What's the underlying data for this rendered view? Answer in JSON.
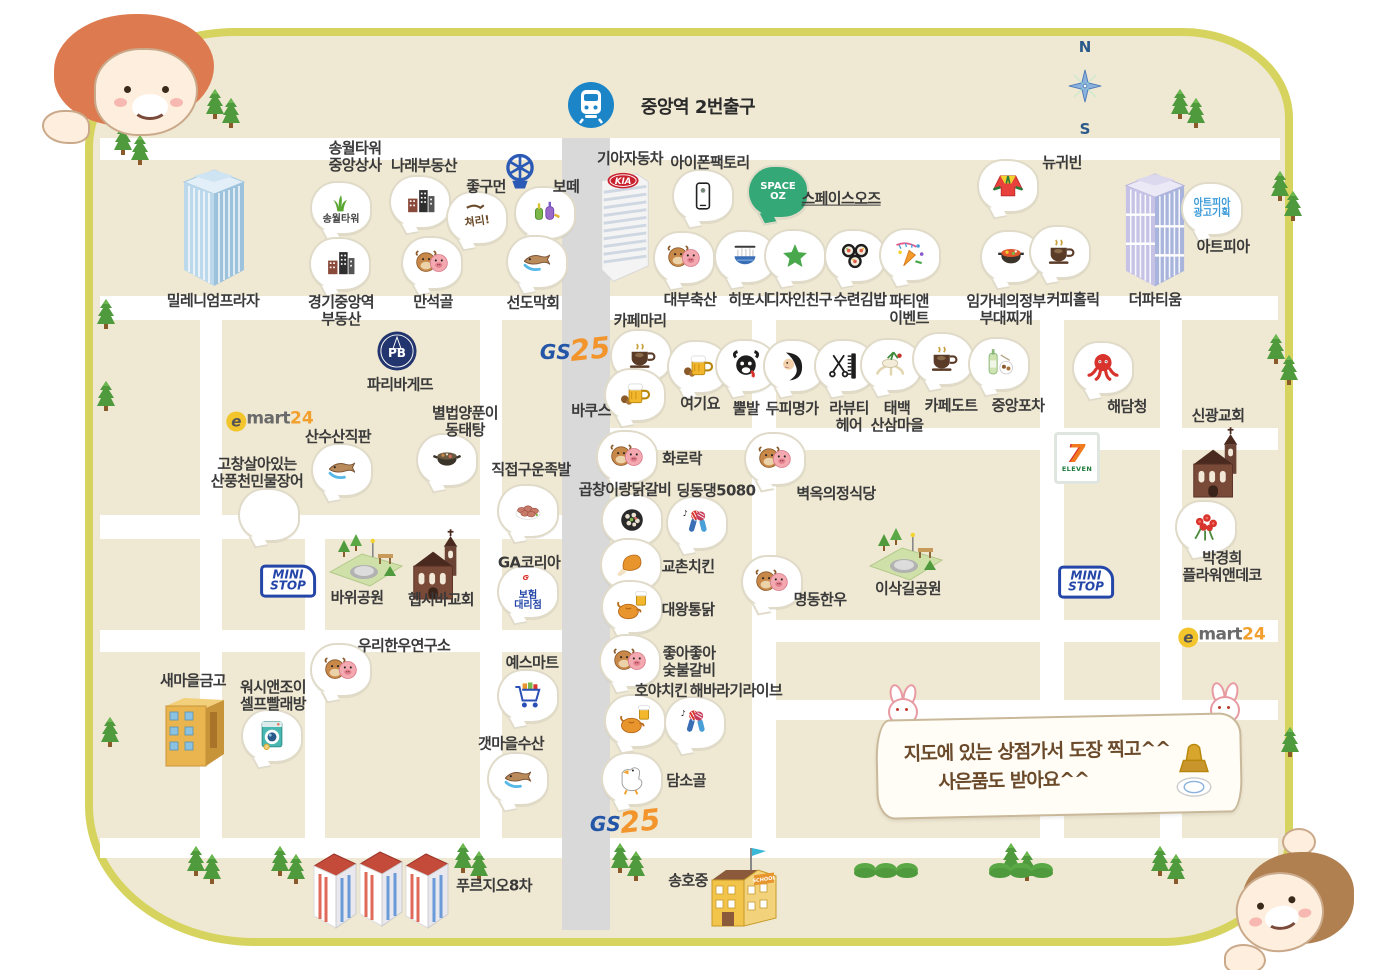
{
  "map": {
    "station_label": "중앙역 2번출구",
    "compass": {
      "n": "N",
      "s": "S"
    },
    "banner": {
      "line1": "지도에 있는 상점가서 도장 찍고^^",
      "line2": "사은품도 받아요^^"
    },
    "colors": {
      "border": "#d6d45f",
      "base": "#efe8d2",
      "road": "#ffffff",
      "main_road": "#d9d9d9",
      "station_blue": "#1b85c8"
    }
  },
  "logos": [
    {
      "name": "gs25-north",
      "kind": "gs25",
      "x": 575,
      "y": 349,
      "t1": "GS",
      "t2": "25"
    },
    {
      "name": "gs25-south",
      "kind": "gs25",
      "x": 625,
      "y": 821,
      "t1": "GS",
      "t2": "25"
    },
    {
      "name": "emart24-west",
      "kind": "emart",
      "x": 270,
      "y": 420,
      "t1": "e",
      "t2": "mart",
      "t3": "24"
    },
    {
      "name": "emart24-east",
      "kind": "emart",
      "x": 1222,
      "y": 636,
      "t1": "e",
      "t2": "mart",
      "t3": "24"
    },
    {
      "name": "ministop-west",
      "kind": "ministop",
      "x": 288,
      "y": 581,
      "t1": "MINI",
      "t2": "STOP"
    },
    {
      "name": "ministop-east",
      "kind": "ministop",
      "x": 1086,
      "y": 582,
      "t1": "MINI",
      "t2": "STOP"
    },
    {
      "name": "seven-eleven",
      "kind": "seven",
      "x": 1077,
      "y": 458,
      "t1": "7",
      "t2": "ELEVEN"
    }
  ],
  "buildings": [
    {
      "name": "millennium-plaza",
      "type": "tower_blue",
      "x": 178,
      "y": 168,
      "label": "밀레니엄프라자",
      "lx": 213,
      "ly": 301
    },
    {
      "name": "the-partium",
      "type": "tower_lav",
      "x": 1120,
      "y": 172,
      "label": "더파티움",
      "lx": 1155,
      "ly": 300
    },
    {
      "name": "kia-motors",
      "type": "kia",
      "x": 594,
      "y": 168,
      "sign": "KIA",
      "label": "기아자동차",
      "lx": 630,
      "ly": 159
    },
    {
      "name": "saemaul-geumgo",
      "type": "bank",
      "x": 158,
      "y": 690,
      "label": "새마을금고",
      "lx": 193,
      "ly": 681
    },
    {
      "name": "shinkwang-church",
      "type": "church",
      "x": 1186,
      "y": 424,
      "label": "신광교회",
      "lx": 1218,
      "ly": 416
    },
    {
      "name": "hepsibah-church",
      "type": "church",
      "x": 406,
      "y": 526,
      "label": "헵시바교회",
      "lx": 441,
      "ly": 600
    },
    {
      "name": "bawi-park",
      "type": "park",
      "x": 320,
      "y": 528,
      "label": "바위공원",
      "lx": 357,
      "ly": 598
    },
    {
      "name": "isakgil-park",
      "type": "park",
      "x": 860,
      "y": 522,
      "label": "이삭길공원",
      "lx": 908,
      "ly": 589
    },
    {
      "name": "prugio-8",
      "type": "apartments",
      "x": 312,
      "y": 850,
      "label": "푸르지오8차",
      "lx": 494,
      "ly": 886
    },
    {
      "name": "songho-middle-school",
      "type": "school",
      "x": 706,
      "y": 846,
      "sign": "SCHOOL",
      "label": "송호중",
      "lx": 688,
      "ly": 881
    }
  ],
  "pois": [
    {
      "name": "songwol-tower-jungang-sangsa",
      "icon": "grass",
      "bubble_text": "송월타워",
      "x": 341,
      "y": 208,
      "label": "송월타워\n중앙상사",
      "lx": 355,
      "ly": 157
    },
    {
      "name": "narae-budongsan",
      "icon": "buildings",
      "x": 420,
      "y": 202,
      "label": "나래부동산",
      "lx": 424,
      "ly": 166
    },
    {
      "name": "jokumeon",
      "icon": "calligraphy",
      "icon_text": "쳐리!",
      "x": 477,
      "y": 218,
      "label": "좋구먼",
      "lx": 486,
      "ly": 187
    },
    {
      "name": "botte",
      "icon": "perfume",
      "x": 545,
      "y": 213,
      "label": "보떼",
      "lx": 566,
      "ly": 187
    },
    {
      "name": "blue-emblem",
      "icon": "emblem",
      "flat": true,
      "x": 520,
      "y": 172,
      "label": ""
    },
    {
      "name": "gyeonggi-jungang-station-budongsan",
      "icon": "buildings",
      "x": 340,
      "y": 264,
      "label": "경기중앙역\n부동산",
      "lx": 341,
      "ly": 311
    },
    {
      "name": "manseokgol",
      "icon": "cowpig",
      "x": 432,
      "y": 263,
      "label": "만석골",
      "lx": 433,
      "ly": 302
    },
    {
      "name": "seondo-makhoe",
      "icon": "fish",
      "x": 537,
      "y": 262,
      "label": "선도막회",
      "lx": 533,
      "ly": 303
    },
    {
      "name": "iphone-factory",
      "icon": "phone",
      "x": 703,
      "y": 196,
      "label": "아이폰팩토리",
      "lx": 710,
      "ly": 163
    },
    {
      "name": "space-oz",
      "icon": "",
      "bubble_text": "SPACE\nOZ",
      "bc": "#35a878",
      "tc": "#ffffff",
      "x": 778,
      "y": 192,
      "label": "스페이스오즈",
      "lx": 841,
      "ly": 199,
      "underline": true
    },
    {
      "name": "daebu-chuksan",
      "icon": "cowpig",
      "x": 684,
      "y": 258,
      "label": "대부축산",
      "lx": 690,
      "ly": 300
    },
    {
      "name": "hittoshi",
      "icon": "noodles",
      "x": 745,
      "y": 257,
      "label": "히또시",
      "lx": 748,
      "ly": 300
    },
    {
      "name": "design-chingu",
      "icon": "star",
      "x": 795,
      "y": 256,
      "label": "디자인친구",
      "lx": 799,
      "ly": 300
    },
    {
      "name": "suryeon-gimbap",
      "icon": "gimbap",
      "x": 855,
      "y": 256,
      "label": "수련김밥",
      "lx": 860,
      "ly": 300
    },
    {
      "name": "party-n-event",
      "icon": "party",
      "x": 910,
      "y": 255,
      "label": "파티앤\n이벤트",
      "lx": 909,
      "ly": 310
    },
    {
      "name": "imgane-uijeongbu-budae-jjigae",
      "icon": "hotpot",
      "x": 1011,
      "y": 257,
      "label": "임가네의정부\n부대찌개",
      "lx": 1006,
      "ly": 310
    },
    {
      "name": "coffee-holic",
      "icon": "coffee",
      "x": 1060,
      "y": 252,
      "label": "커피홀릭",
      "lx": 1073,
      "ly": 300
    },
    {
      "name": "new-gwibin",
      "icon": "hanbok",
      "x": 1008,
      "y": 186,
      "label": "뉴귀빈",
      "lx": 1062,
      "ly": 163
    },
    {
      "name": "artpia-ad-planning",
      "icon": "",
      "bubble_text": "아트피아\n광고기획",
      "tc": "#3a9ad8",
      "x": 1212,
      "y": 209,
      "label": "아트피아",
      "lx": 1223,
      "ly": 247
    },
    {
      "name": "cafe-mari",
      "icon": "coffee",
      "x": 641,
      "y": 356,
      "label": "카페마리",
      "lx": 640,
      "ly": 321
    },
    {
      "name": "bacchus",
      "icon": "beer",
      "x": 635,
      "y": 395,
      "label": "바쿠스",
      "lx": 591,
      "ly": 411
    },
    {
      "name": "yeogiyo",
      "icon": "beer",
      "x": 698,
      "y": 367,
      "label": "여기요",
      "lx": 700,
      "ly": 404
    },
    {
      "name": "ppulbal",
      "icon": "bull",
      "x": 746,
      "y": 366,
      "label": "뿔발",
      "lx": 746,
      "ly": 409
    },
    {
      "name": "dupi-myeongga",
      "icon": "scalp",
      "x": 794,
      "y": 366,
      "label": "두피명가",
      "lx": 792,
      "ly": 409
    },
    {
      "name": "la-beauty-hair",
      "icon": "scissors",
      "x": 845,
      "y": 366,
      "label": "라뷰티\n헤어",
      "lx": 849,
      "ly": 417
    },
    {
      "name": "taebaek-sansam-maeul",
      "icon": "ginseng",
      "x": 891,
      "y": 365,
      "label": "태백\n산삼마을",
      "lx": 897,
      "ly": 417
    },
    {
      "name": "cafe-dot",
      "icon": "coffee",
      "x": 943,
      "y": 359,
      "label": "카페도트",
      "lx": 951,
      "ly": 406
    },
    {
      "name": "jungang-pocha",
      "icon": "soju",
      "x": 999,
      "y": 364,
      "label": "중앙포차",
      "lx": 1018,
      "ly": 406
    },
    {
      "name": "haedamcheong",
      "icon": "octopus",
      "x": 1103,
      "y": 368,
      "label": "해담청",
      "lx": 1127,
      "ly": 407
    },
    {
      "name": "paris-baguette",
      "icon": "pb",
      "sign": "PB",
      "flat": true,
      "x": 397,
      "y": 351,
      "label": "파리바게뜨",
      "lx": 400,
      "ly": 385
    },
    {
      "name": "sansusan-jikpan",
      "icon": "fish",
      "x": 342,
      "y": 470,
      "label": "산수산직판",
      "lx": 338,
      "ly": 437
    },
    {
      "name": "byeolbeop-yangpuni-dongtaetang",
      "icon": "pot",
      "x": 447,
      "y": 460,
      "label": "별법양푼이\n동태탕",
      "lx": 465,
      "ly": 422
    },
    {
      "name": "gochang-minmul-jangeo",
      "icon": "eel",
      "x": 269,
      "y": 515,
      "label": "고창살아있는\n산풍천민물장어",
      "lx": 257,
      "ly": 473
    },
    {
      "name": "jikjeop-guun-jokbal",
      "icon": "pork",
      "x": 528,
      "y": 511,
      "label": "직접구운족발",
      "lx": 531,
      "ly": 470
    },
    {
      "name": "hwarorak",
      "icon": "cowpig",
      "x": 627,
      "y": 457,
      "label": "화로락",
      "lx": 682,
      "ly": 459
    },
    {
      "name": "gopchang-irang-dakgalbi",
      "icon": "pan",
      "x": 632,
      "y": 520,
      "label": "곱창이랑닭갈비",
      "lx": 625,
      "ly": 490
    },
    {
      "name": "dingdongdaeng-5080",
      "icon": "mics",
      "x": 697,
      "y": 523,
      "label": "딩동댕5080",
      "lx": 716,
      "ly": 491
    },
    {
      "name": "byeokok-uijeong-sikdang",
      "icon": "cowpig",
      "x": 775,
      "y": 459,
      "label": "벽옥의정식당",
      "lx": 836,
      "ly": 494
    },
    {
      "name": "kyochon-chicken",
      "icon": "chicken",
      "x": 631,
      "y": 565,
      "label": "교촌치킨",
      "lx": 688,
      "ly": 567
    },
    {
      "name": "daewang-tongdak",
      "icon": "chickbeer",
      "x": 632,
      "y": 607,
      "label": "대왕통닭",
      "lx": 688,
      "ly": 610
    },
    {
      "name": "myeongdong-hanwoo",
      "icon": "cowpig",
      "x": 772,
      "y": 582,
      "label": "명동한우",
      "lx": 820,
      "ly": 600
    },
    {
      "name": "ga-korea-insurance",
      "icon": "gmark",
      "bubble_text": "보험\n대리점",
      "tc": "#2446a8",
      "x": 528,
      "y": 592,
      "label": "GA코리아",
      "lx": 529,
      "ly": 563
    },
    {
      "name": "yes-mart",
      "icon": "cart",
      "x": 528,
      "y": 696,
      "label": "예스마트",
      "lx": 532,
      "ly": 663
    },
    {
      "name": "woori-hanwoo-yeonguso",
      "icon": "cowpig",
      "x": 341,
      "y": 670,
      "label": "우리한우연구소",
      "lx": 404,
      "ly": 646
    },
    {
      "name": "wash-n-joy-laundry",
      "icon": "washer",
      "x": 272,
      "y": 736,
      "label": "워시앤조이\n셀프빨래방",
      "lx": 273,
      "ly": 696
    },
    {
      "name": "gaetmaeul-susan",
      "icon": "fish",
      "x": 518,
      "y": 779,
      "label": "갯마을수산",
      "lx": 511,
      "ly": 744
    },
    {
      "name": "joajoa-sutbul-galbi",
      "icon": "cowpig",
      "x": 630,
      "y": 661,
      "label": "좋아좋아\n숯불갈비",
      "lx": 689,
      "ly": 662
    },
    {
      "name": "hoya-chicken",
      "icon": "chickbeer",
      "x": 635,
      "y": 721,
      "label": "호야치킨",
      "lx": 661,
      "ly": 691
    },
    {
      "name": "haebaragi-live",
      "icon": "mics",
      "x": 695,
      "y": 723,
      "label": "해바라기라이브",
      "lx": 736,
      "ly": 691
    },
    {
      "name": "damsogol",
      "icon": "duck",
      "x": 632,
      "y": 779,
      "label": "담소골",
      "lx": 686,
      "ly": 781
    },
    {
      "name": "park-kyunghee-flower-n-deco",
      "icon": "flowers",
      "x": 1206,
      "y": 527,
      "label": "박경희\n플라워앤데코",
      "lx": 1222,
      "ly": 567
    }
  ],
  "decor": {
    "trees": [
      [
        205,
        88
      ],
      [
        221,
        97
      ],
      [
        113,
        124
      ],
      [
        130,
        134
      ],
      [
        1170,
        88
      ],
      [
        1186,
        97
      ],
      [
        1270,
        170
      ],
      [
        1283,
        190
      ],
      [
        1266,
        333
      ],
      [
        1279,
        354
      ],
      [
        96,
        298
      ],
      [
        96,
        380
      ],
      [
        100,
        716
      ],
      [
        186,
        845
      ],
      [
        202,
        853
      ],
      [
        270,
        845
      ],
      [
        286,
        853
      ],
      [
        453,
        842
      ],
      [
        469,
        850
      ],
      [
        610,
        842
      ],
      [
        626,
        850
      ],
      [
        1001,
        842
      ],
      [
        1017,
        850
      ],
      [
        1150,
        845
      ],
      [
        1166,
        853
      ],
      [
        1280,
        726
      ]
    ],
    "bushes": [
      [
        853,
        862
      ],
      [
        874,
        862
      ],
      [
        895,
        862
      ],
      [
        988,
        862
      ],
      [
        1009,
        862
      ],
      [
        1030,
        862
      ]
    ]
  }
}
